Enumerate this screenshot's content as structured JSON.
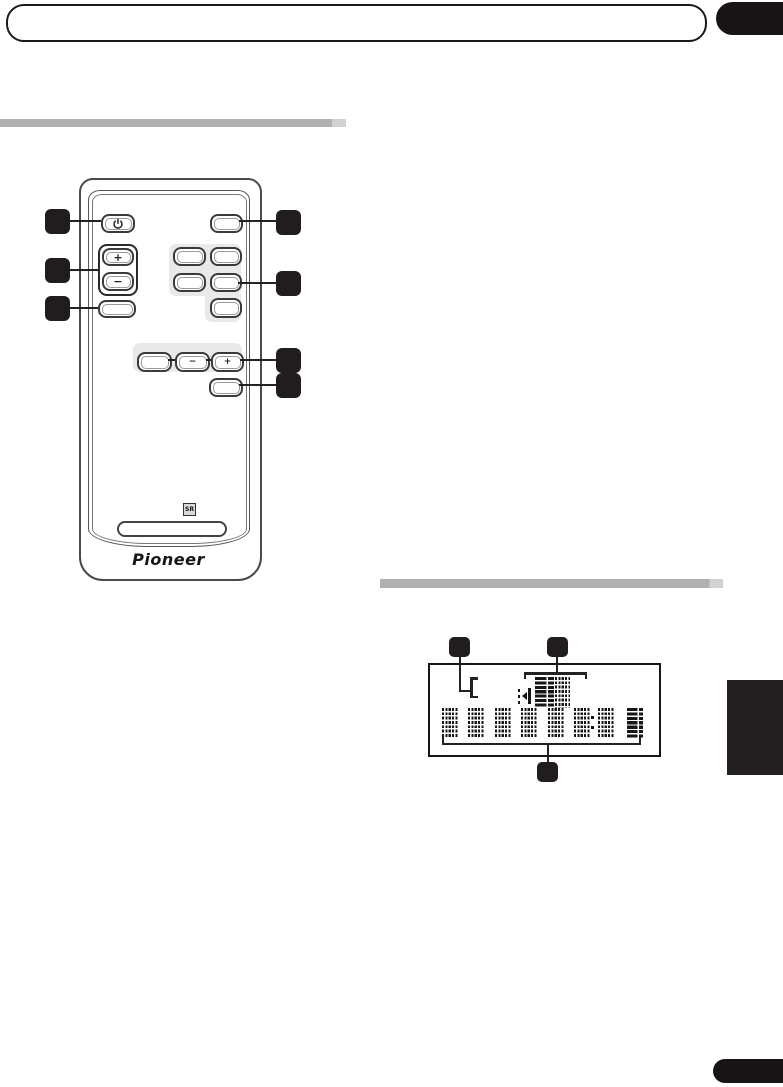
{
  "document": {
    "kind": "instruction-manual-page"
  },
  "colors": {
    "ink": "#1a1a1a",
    "section_bar_gray": "#b1b1b1",
    "remote_panel_gray": "#e9e9e9",
    "callout_black": "#211d1e"
  },
  "remote": {
    "brand_label": "Pioneer",
    "sr_mark": "SR",
    "buttons": {
      "power_icon": "power-symbol",
      "volume_plus": "+",
      "volume_minus": "−",
      "tune_minus": "−",
      "tune_plus": "+"
    },
    "callouts_left_count": 3,
    "callouts_right_count": 4
  },
  "display_panel": {
    "callouts_top_count": 2,
    "callouts_bottom_count": 1,
    "character_cells_bottom_row": 8,
    "character_cells_top_row": 2,
    "colon_present": true
  }
}
